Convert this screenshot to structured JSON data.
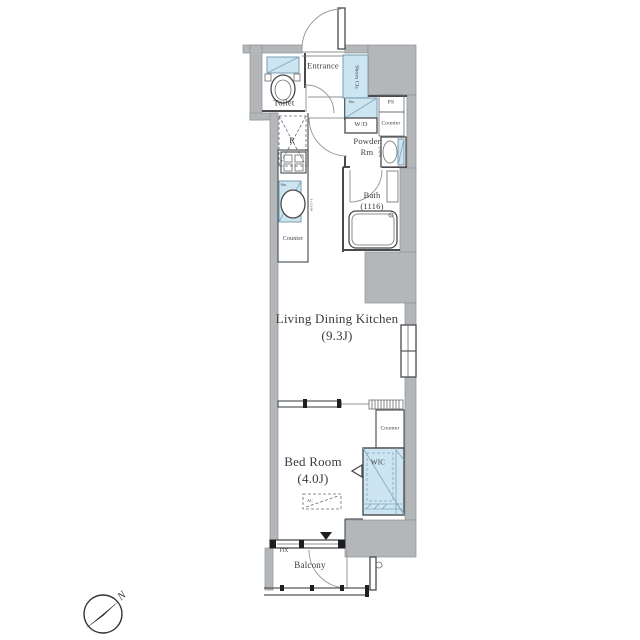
{
  "plan_type": "apartment-floorplan",
  "colors": {
    "wall_fill": "#b4b7ba",
    "fixture_fill": "#cde5f1",
    "line": "#4a4a4e",
    "text": "#3b3b3b",
    "background": "#ffffff"
  },
  "labels": {
    "toilet": "Toilet",
    "entrance": "Entrance",
    "shoes_closet": "Shoes Cls",
    "washer_dryer": "W/D",
    "pipe_space": "PS",
    "powder_counter": "Counter",
    "powder_room": "Powder\nRm",
    "storage_powder": "Sto.",
    "vanity_length": "L=670",
    "bath": "Bath\n(1116)",
    "refrigerator": "R",
    "storage_kitchen": "Sto.",
    "kitchen_counter": "Counter",
    "kitchen_length": "L=2,100",
    "living_dining_kitchen": "Living Dining Kitchen\n(9.3J)",
    "bedroom_counter": "Counter",
    "wic": "WIC",
    "bedroom": "Bed Room\n(4.0J)",
    "air_conditioner": "AC",
    "fix_window": "FIX",
    "balcony": "Balcony",
    "compass_north": "N"
  }
}
